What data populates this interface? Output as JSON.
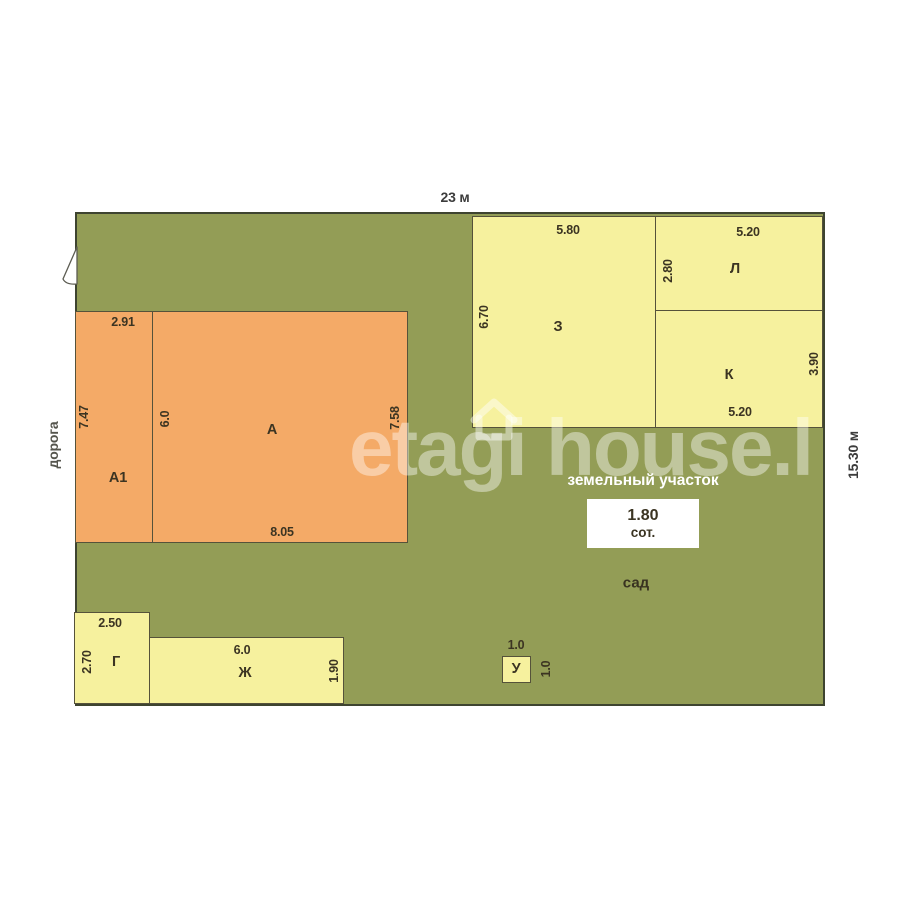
{
  "plan": {
    "top_dimension": "23 м",
    "right_dimension": "15.30 м",
    "road": "дорога",
    "garden": "сад",
    "area_box": {
      "caption": "земельный участок",
      "value": "1.80",
      "unit": "сот."
    }
  },
  "buildings": {
    "a1": {
      "name": "А1",
      "top": "2.91",
      "left": "7.47"
    },
    "a": {
      "name": "А",
      "left": "6.0",
      "right": "7.58",
      "bottom": "8.05"
    },
    "z": {
      "name": "З",
      "top": "5.80",
      "left": "6.70"
    },
    "l": {
      "name": "Л",
      "top": "5.20",
      "left": "2.80"
    },
    "k": {
      "name": "К",
      "right": "3.90",
      "bottom": "5.20"
    },
    "g": {
      "name": "Г",
      "top": "2.50",
      "left": "2.70"
    },
    "zh": {
      "name": "Ж",
      "top": "6.0",
      "right": "1.90"
    },
    "u": {
      "name": "У",
      "top": "1.0",
      "right": "1.0"
    }
  },
  "watermark": {
    "text": "etagi house.l"
  },
  "colors": {
    "land_green": "#939d56",
    "main_building_orange": "#f4aa67",
    "outbuilding_yellow": "#f6f19e",
    "plot_outline": "#3e4430",
    "label_text": "#3b3422",
    "caption_white": "#ffffff"
  }
}
